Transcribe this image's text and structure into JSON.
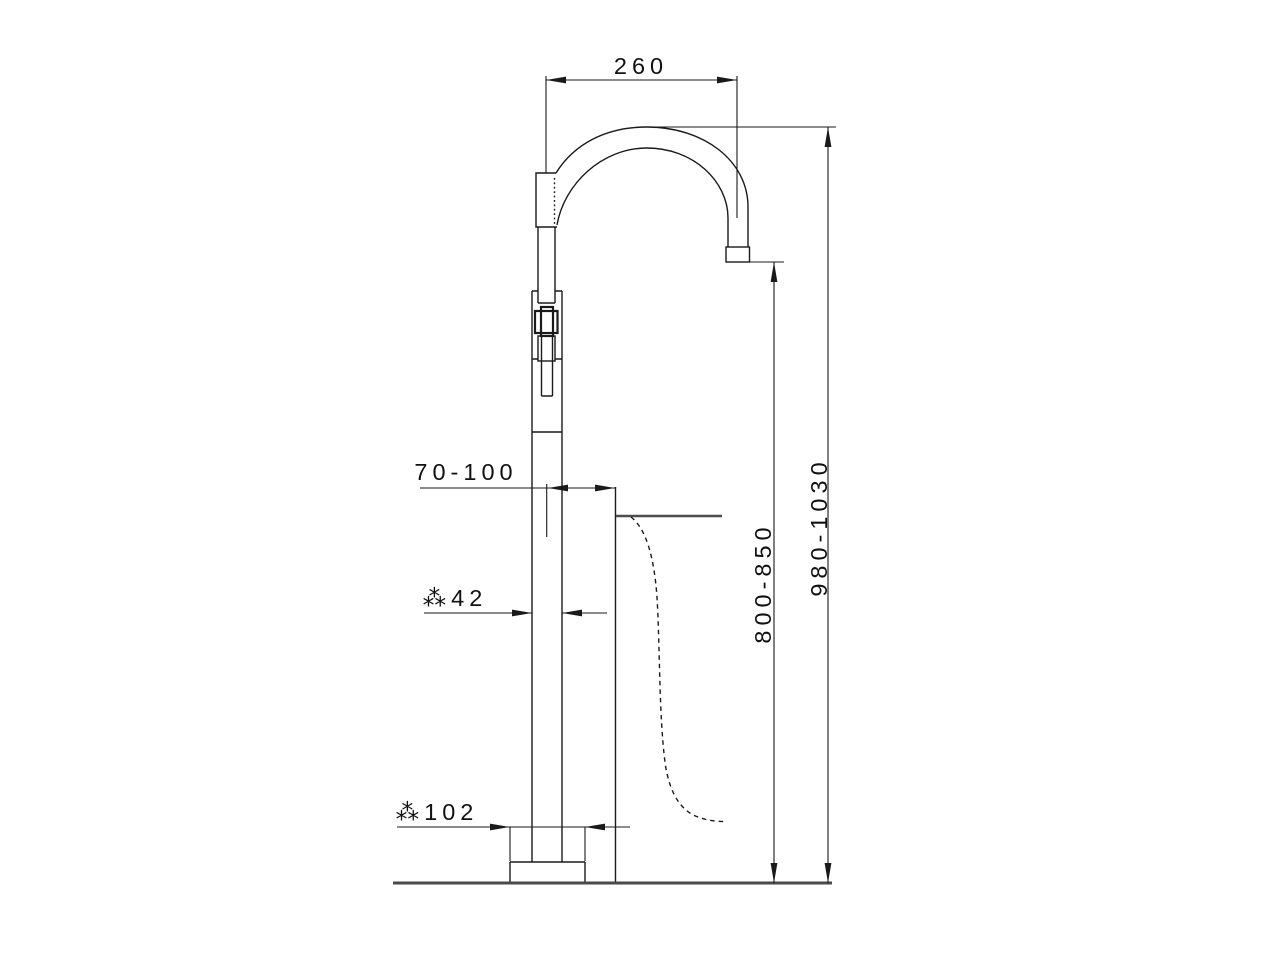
{
  "drawing": {
    "background": "#ffffff",
    "line_color": "#1a1a1a",
    "ground_line_color": "#4a4a4a",
    "dimensions": {
      "spout_projection": "260",
      "overall_height": "980-1030",
      "spout_outlet_height": "800-850",
      "axis_to_tub_edge": "70-100",
      "column_diameter": "⁂42",
      "base_diameter": "⁂102"
    }
  }
}
